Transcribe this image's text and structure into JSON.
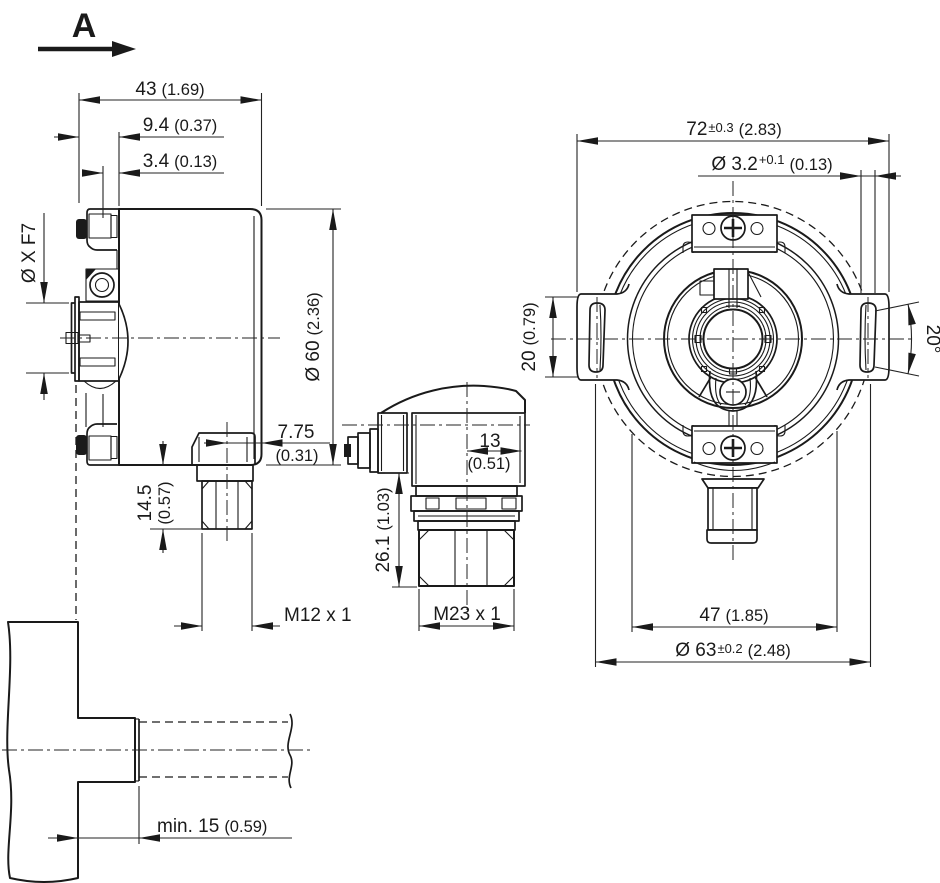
{
  "view_arrow": {
    "label": "A"
  },
  "side_view": {
    "width_mm": "43",
    "width_in": "(1.69)",
    "flange_depth_mm": "9.4",
    "flange_depth_in": "(0.37)",
    "step_depth_mm": "3.4",
    "step_depth_in": "(0.13)",
    "shaft_dia": "Ø X F7",
    "body_dia_mm": "Ø 60",
    "body_dia_in": "(2.36)",
    "m12_offset_mm": "7.75",
    "m12_offset_in": "(0.31)",
    "m12_height_mm": "14.5",
    "m12_height_in": "(0.57)",
    "m12_thread": "M12 x 1"
  },
  "m23_view": {
    "offset_mm": "13",
    "offset_in": "(0.51)",
    "height_mm": "26.1",
    "height_in": "(1.03)",
    "thread": "M23 x 1"
  },
  "front_view": {
    "tab_span_mm": "72",
    "tab_span_tol": "±0.3",
    "tab_span_in": "(2.83)",
    "slot_width_mm": "Ø 3.2",
    "slot_width_tol": "+0.1",
    "slot_width_in": "(0.13)",
    "slot_len_mm": "20",
    "slot_len_in": "(0.79)",
    "slot_angle": "20°",
    "clamp_span_mm": "47",
    "clamp_span_in": "(1.85)",
    "outer_dia_mm": "Ø 63",
    "outer_dia_tol": "±0.2",
    "outer_dia_in": "(2.48)"
  },
  "mount_view": {
    "min_depth_mm": "min. 15",
    "min_depth_in": "(0.59)"
  }
}
